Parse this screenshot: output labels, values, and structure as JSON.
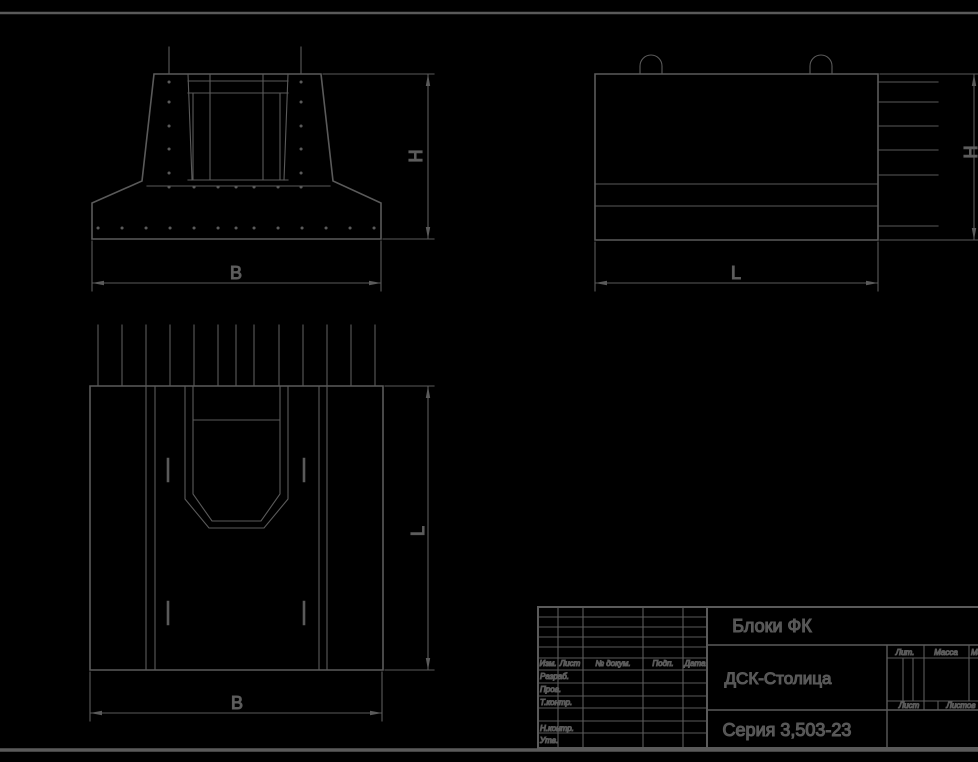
{
  "drawing": {
    "background_color": "#000000",
    "line_color": "#5a5a5a",
    "text_color": "#5c5c5c",
    "kind": "engineering-drawing"
  },
  "views": {
    "front": {
      "width_label": "B",
      "height_label": "H"
    },
    "side": {
      "width_label": "L",
      "height_label": "H"
    },
    "plan": {
      "width_label": "B",
      "height_label": "L"
    }
  },
  "title_block": {
    "product_title": "Блоки ФК",
    "organization": "ДСК-Столица",
    "document": "Серия 3,503-23",
    "header_cols": [
      "Изм.",
      "Лист",
      "№ докум.",
      "Подп.",
      "Дата"
    ],
    "signature_rows": [
      "Разраб.",
      "Пров.",
      "Т.контр.",
      "",
      "Н.контр.",
      "Утв."
    ],
    "right_headers": {
      "lit": "Лит.",
      "mass": "Масса",
      "scale": "Масштаб"
    },
    "sheet_row": {
      "sheet": "Лист",
      "sheets": "Листов"
    }
  }
}
